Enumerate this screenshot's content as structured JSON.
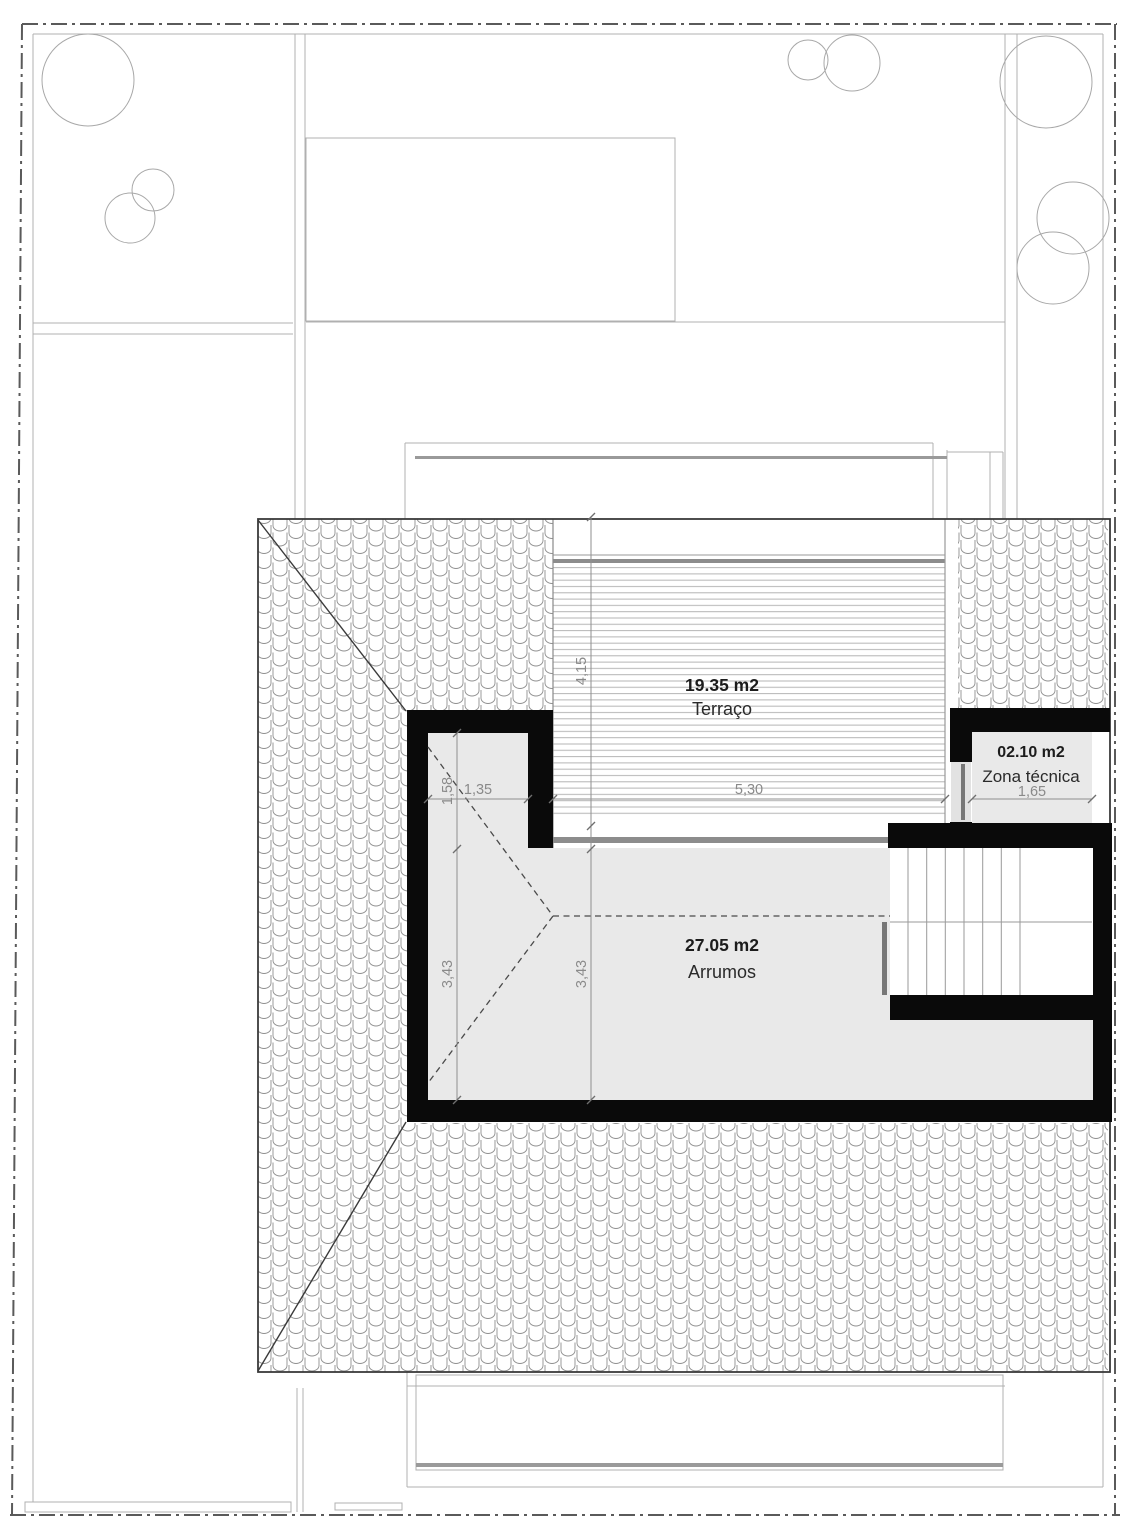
{
  "drawing": {
    "type": "roof-attic-floor-plan",
    "rooms": {
      "terraco": {
        "area": "19.35 m2",
        "name": "Terraço"
      },
      "zona_tecnica": {
        "area": "02.10 m2",
        "name": "Zona técnica"
      },
      "arrumos": {
        "area": "27.05 m2",
        "name": "Arrumos"
      }
    },
    "dimensions": {
      "terrace_depth": "4,15",
      "terrace_width": "5,30",
      "zona_tecnica_width": "1,65",
      "notch_width": "1,35",
      "notch_depth": "1,58",
      "left_span": "3,43",
      "inner_span": "3,43"
    },
    "colors": {
      "wall": "#0a0a0a",
      "room_fill": "#e9e9e9",
      "deck_band": "#8c8c8c",
      "handrail": "#777777",
      "dim_line": "#8f8f8f",
      "dim_text": "#8a8a8a",
      "garden_line": "#b0b0b0",
      "boundary": "#5a5a5a",
      "building_outline": "#3a3a3a"
    }
  }
}
